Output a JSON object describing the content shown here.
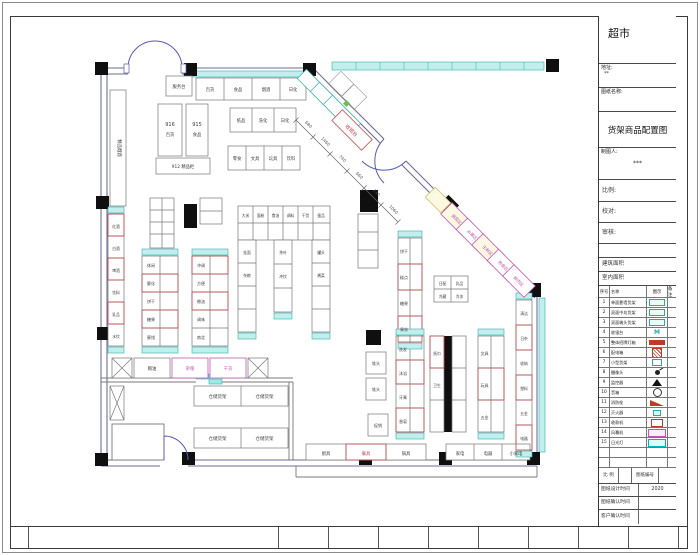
{
  "title_block": {
    "store_name": "超市",
    "address_label": "地址:",
    "address_value": "**",
    "drawing_name_label": "图纸名称:",
    "drawing_title": "货架商品配置图",
    "drafter_label": "制图人:",
    "drafter_value": "***",
    "info_fields": [
      {
        "label": "比例:"
      },
      {
        "label": "校对:"
      },
      {
        "label": "审核:"
      },
      {
        "label": ""
      },
      {
        "label": "建筑面积"
      },
      {
        "label": "室内面积"
      }
    ],
    "legend": {
      "headers": [
        "序号",
        "名称",
        "图示",
        "备注"
      ],
      "rows": [
        {
          "no": "1",
          "name": "单面靠墙货架"
        },
        {
          "no": "2",
          "name": "双面中岛货架"
        },
        {
          "no": "3",
          "name": "双面端头货架"
        },
        {
          "no": "4",
          "name": "收银台"
        },
        {
          "no": "5",
          "name": "整体招牌灯箱"
        },
        {
          "no": "6",
          "name": "配电箱"
        },
        {
          "no": "7",
          "name": "小型货架"
        },
        {
          "no": "8",
          "name": "摄像头"
        },
        {
          "no": "9",
          "name": "监控器"
        },
        {
          "no": "10",
          "name": "音箱"
        },
        {
          "no": "11",
          "name": "消防栓"
        },
        {
          "no": "12",
          "name": "灭火器"
        },
        {
          "no": "13",
          "name": "收款机"
        },
        {
          "no": "14",
          "name": "风幕机"
        },
        {
          "no": "15",
          "name": "日光灯"
        },
        {
          "no": "",
          "name": ""
        },
        {
          "no": "",
          "name": ""
        }
      ]
    },
    "footer": {
      "scale_label": "比 例",
      "scale_value": "",
      "number_label": "图纸编号",
      "number_value": "",
      "rows": [
        {
          "label": "图纸设计时间",
          "value": "2020"
        },
        {
          "label": "图纸确认时间",
          "value": ""
        },
        {
          "label": "客户确认时间",
          "value": ""
        }
      ]
    }
  },
  "plan": {
    "labels": {
      "service_desk": "服务台",
      "top_shelves": [
        "百货",
        "食品",
        "烟酒",
        "日化"
      ],
      "left_vertical_case": "精品烟酒",
      "box916_no": "916",
      "box916_name": "百货",
      "box915_no": "915",
      "box915_name": "食品",
      "box912": "912 精品柜",
      "grid_row1": [
        "纸品",
        "洗化",
        "日化"
      ],
      "grid_row2": [
        "零食",
        "文具",
        "玩具",
        "饮料"
      ],
      "checkout": "收银台",
      "diag_shelves": [
        "蔬菜区",
        "水果区",
        "生鲜区",
        "熟食区",
        "鲜肉区"
      ],
      "left_wall_shelves": [
        "红酒",
        "白酒",
        "啤酒",
        "饮料",
        "乳品",
        "水饮"
      ],
      "gondola_a": [
        "休闲",
        "膨化",
        "饼干",
        "糖果",
        "蜜饯"
      ],
      "gondola_b": [
        "冲调",
        "方便",
        "粮油",
        "调味",
        "南北"
      ],
      "u_top": [
        "大米",
        "面粉",
        "食油",
        "调料",
        "干货",
        "蛋品"
      ],
      "u_left": [
        "挂面",
        "杂粮"
      ],
      "u_mid": [
        "茶叶",
        "冲饮"
      ],
      "u_right": [
        "罐头",
        "酱菜"
      ],
      "gondola_c": [
        "饼干",
        "糕点",
        "糖果",
        "果冻"
      ],
      "dairy_island": [
        "日配",
        "乳品",
        "冷藏",
        "冷冻"
      ],
      "gondola_d": [
        "洗发",
        "沐浴",
        "牙膏",
        "香皂"
      ],
      "gondola_e": [
        "纸巾",
        "卫生"
      ],
      "gondola_f": [
        "文具",
        "玩具",
        "五金"
      ],
      "right_wall_shelves": [
        "清洁",
        "日杂",
        "收纳",
        "塑料",
        "五金",
        "电器"
      ],
      "bottom_left_shelves": [
        "厨具",
        "餐具",
        "锅具"
      ],
      "bottom_right_shelves": [
        "家电",
        "电器",
        "小家电"
      ],
      "promo_row": [
        "粮油",
        "杂粮",
        "干货"
      ],
      "storage_racks": [
        "仓储货架",
        "仓储货架",
        "仓储货架",
        "仓储货架"
      ],
      "small_piles": [
        "堆头",
        "堆头",
        "促销"
      ]
    },
    "dimensions": [
      "680",
      "1460",
      "740",
      "660",
      "730",
      "1060"
    ]
  },
  "colors": {
    "wall": "#6e6e96",
    "shelf_red": "#c34a4a",
    "cap_cyan": "#2fb3ac",
    "magenta": "#c257b2",
    "column": "#0f0f0f",
    "cyan_band": "#c2efed"
  }
}
